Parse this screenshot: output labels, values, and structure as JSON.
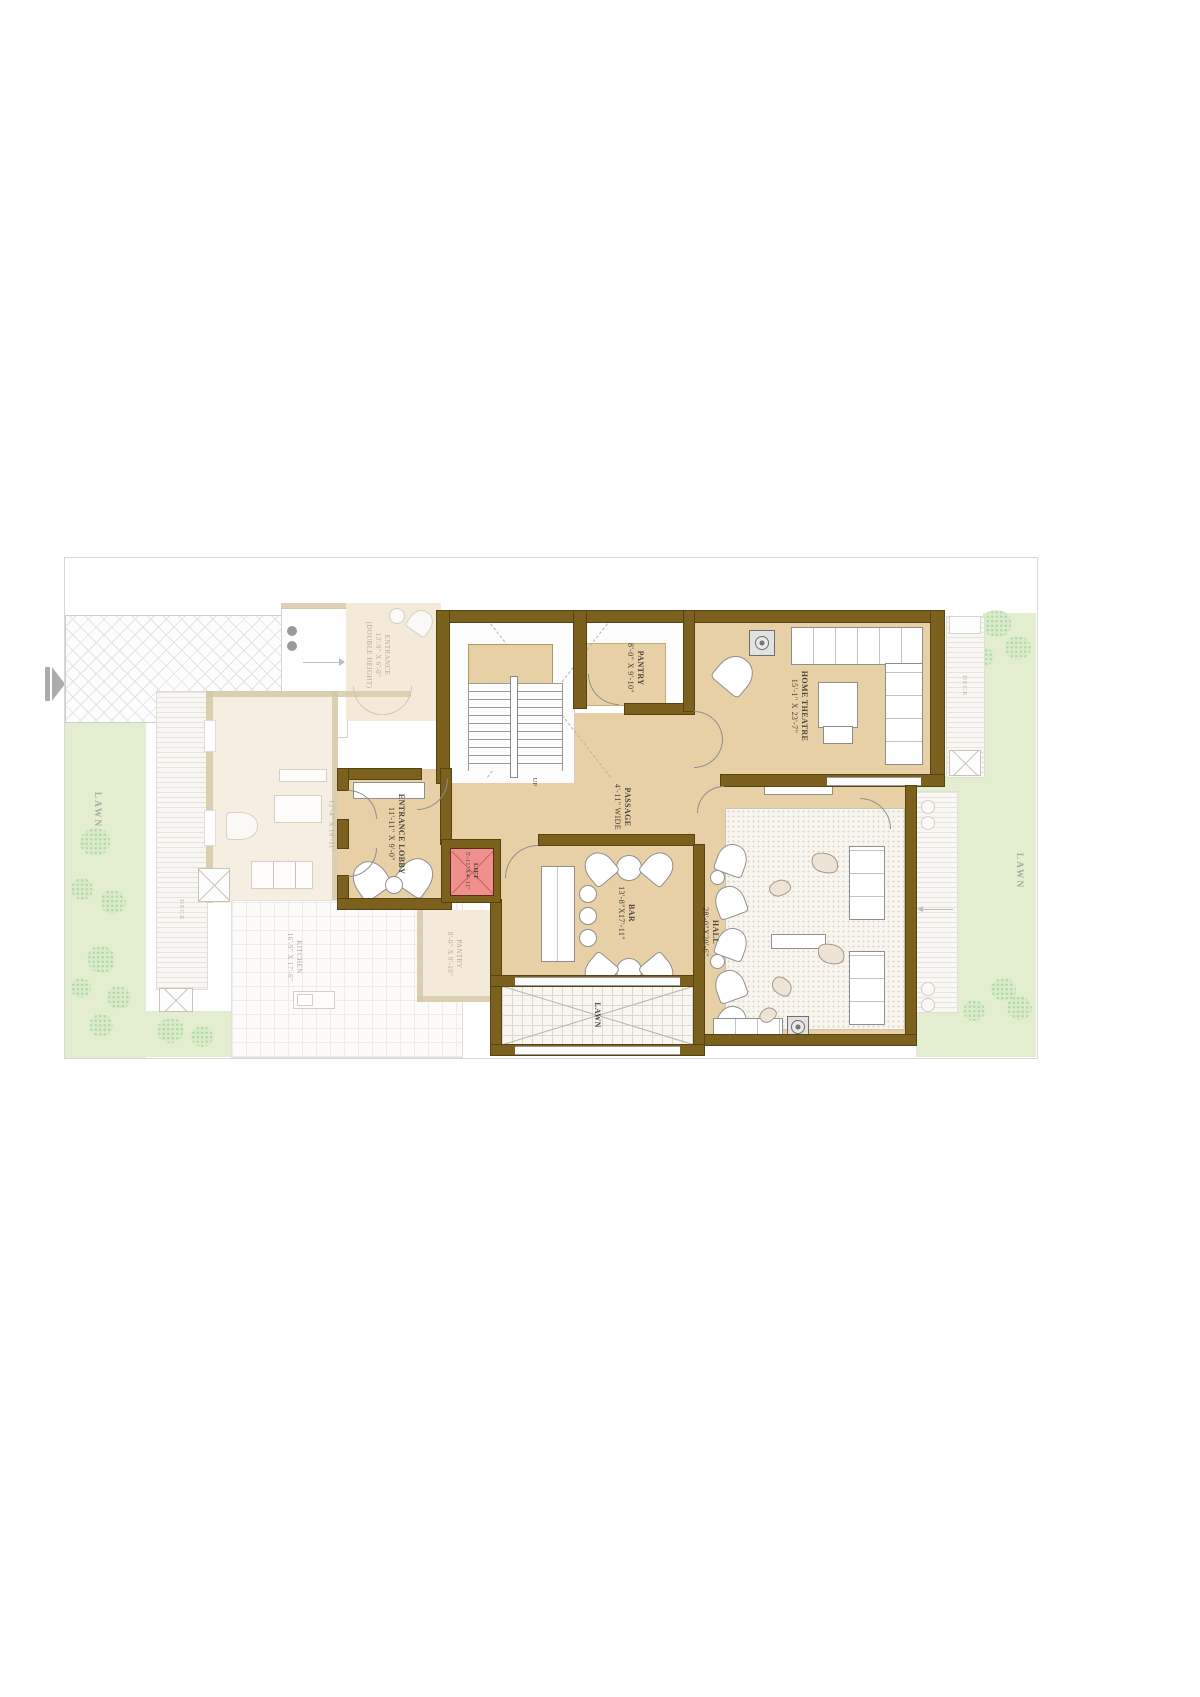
{
  "viewer": {
    "next_icon": "play-triangle-with-bar"
  },
  "plan": {
    "rooms": {
      "stairs": {
        "direction_label": "UP"
      },
      "pantry": {
        "name": "PANTRY",
        "dims": "8'-0\" X 9'-10\""
      },
      "home_theatre": {
        "name": "HOME THEATRE",
        "dims": "15'-1\" X 23'-7\""
      },
      "passage": {
        "name": "PASSAGE",
        "dims": "4'-11\" WIDE"
      },
      "entrance_lobby": {
        "name": "ENTRANCE LOBBY",
        "dims": "11'-11\" X 9'-0\""
      },
      "lift": {
        "name": "LIFT",
        "dims": "5'-11\"X4'-11\""
      },
      "bar": {
        "name": "BAR",
        "dims": "13'-8\"X17'-11\""
      },
      "hall": {
        "name": "HALL",
        "dims": "28'-0\"X20'-6\""
      },
      "lawn_court": {
        "name": "LAWN"
      }
    },
    "ghost": {
      "entrance": {
        "name": "ENTRANCE",
        "dims": "13'-9\" X 6'-0\"",
        "note": "(DOUBLE HEIGHT)"
      },
      "living": {
        "dims": "12'-4\" X 18'-11\""
      },
      "kitchen": {
        "name": "KITCHEN",
        "dims": "16'-9\" X 17'-6\""
      },
      "pantry": {
        "name": "PANTRY",
        "dims": "8'-0\" X 9'-10\""
      },
      "deck_left": {
        "name": "DECK"
      },
      "deck_right": {
        "name": "DECK"
      }
    },
    "site": {
      "lawn_left": "LAWN",
      "lawn_right": "LAWN"
    },
    "colors": {
      "wall": "#7c601e",
      "room_fill": "#e7d0a6",
      "lift_fill": "#f0908d",
      "lawn": "#e3eed1",
      "ghost_wall": "#d5c7a6",
      "arrow_gray": "#acacac"
    }
  }
}
